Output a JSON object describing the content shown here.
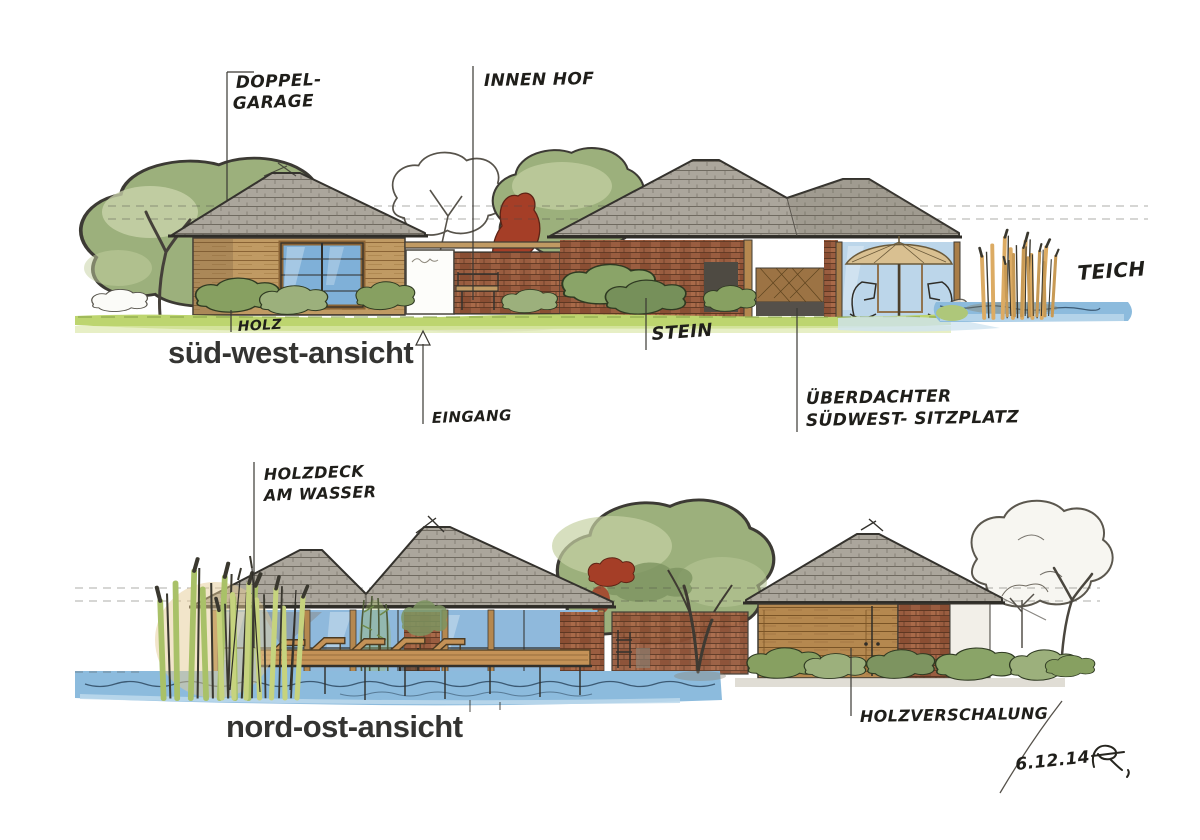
{
  "palette": {
    "paper": "#ffffff",
    "ink": "#2f2d28",
    "roof_gray": "#aba69c",
    "roof_line": "#6f6a60",
    "wood_light": "#c09a63",
    "wood_plank": "#b5884f",
    "brick": "#9a5d40",
    "foliage": "#9cb07c",
    "foliage_light": "#ccd6ae",
    "shrub_dark": "#87a061",
    "grass": "#bdd56f",
    "water": "#8cbbdd",
    "window_blue": "#7fb0d8",
    "reed_tan": "#dcab63",
    "reed_green": "#a9c168",
    "red_foliage": "#a53e27",
    "parasol": "#d9c091"
  },
  "titles": {
    "south_west": "süd-west-ansicht",
    "north_east": "nord-ost-ansicht"
  },
  "annotations": {
    "doppel1": "DOPPEL-",
    "doppel2": "GARAGE",
    "innenhof": "INNEN HOF",
    "holz": "HOLZ",
    "eingang": "EINGANG",
    "stein": "STEIN",
    "ueberdacht1": "ÜBERDACHTER",
    "ueberdacht2": "SÜDWEST- SITZPLATZ",
    "teich": "TEICH",
    "holzdeck1": "HOLZDECK",
    "holzdeck2": "AM WASSER",
    "holzverschalung": "HOLZVERSCHALUNG",
    "date": "6.12.14"
  }
}
